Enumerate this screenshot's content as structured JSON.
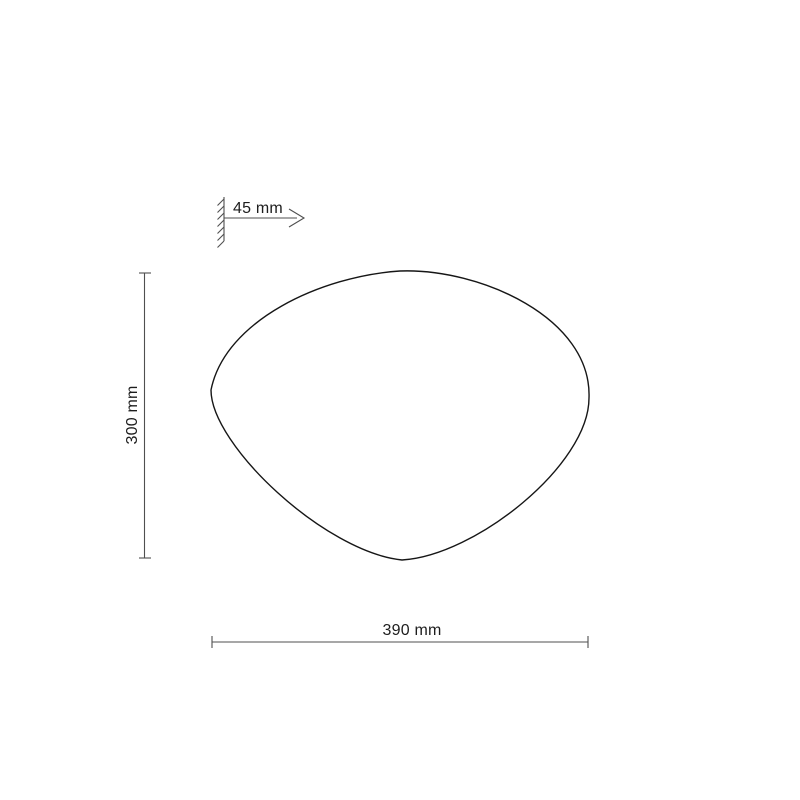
{
  "diagram": {
    "labels": {
      "depth": "45 mm",
      "height": "300 mm",
      "width": "390 mm"
    },
    "colors": {
      "background": "#ffffff",
      "outline": "#161616",
      "dimension_line": "#4f4f4f",
      "text": "#1d1d1d"
    },
    "icons": {
      "wall_mount_hatch": "hatched-wall-mount-symbol",
      "depth_arrow": "right-open-arrow"
    }
  }
}
